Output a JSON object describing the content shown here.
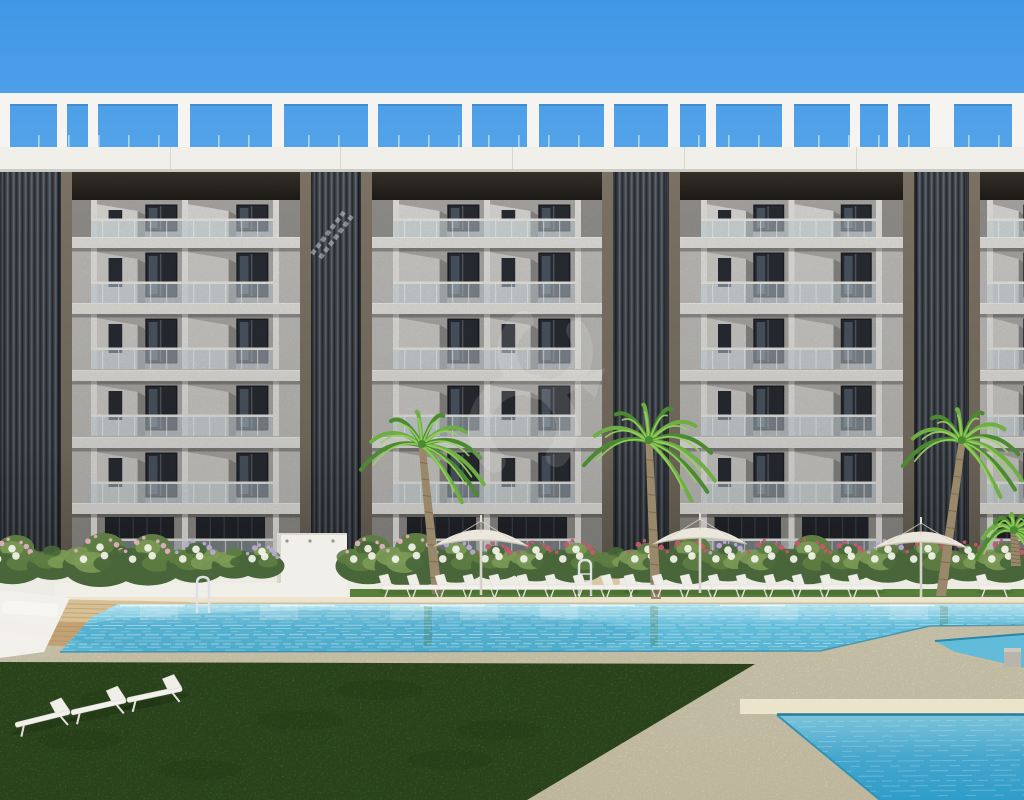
{
  "scene": {
    "description": "Sunny 3D architectural rendering of a modern six-storey apartment residence with a white rooftop pergola, dark vertical louvre towers, glass balconies, palm trees, a flowering hedge, sun loungers, parasols and turquoise communal swimming pools",
    "time_of_day": "day",
    "readable_text": "none",
    "watermark": {
      "present": true,
      "style": "faint white abstract swirl monogram",
      "opacity": 0.13
    }
  },
  "colors": {
    "sky_top": "#4097e6",
    "sky_mid": "#6fb5ef",
    "sky_bottom": "#9ccff5",
    "pergola_white": "#f5f4f0",
    "fascia_white": "#f0efe9",
    "slab_white": "#ecebe6",
    "recess_dark_top": "#3a342c",
    "recess_dark_bottom": "#201d19",
    "facade_light": "#c7c6c3",
    "facade_mid": "#b2b0ad",
    "facade_shadow": "#8f8d8a",
    "wedge_bright": "#d7d5d1",
    "pillar_white": "#edece8",
    "window_dark": "#2b2e35",
    "window_frame": "#1d2026",
    "window_reflection": "#7d91a4",
    "glass_railing": "#cfdde3",
    "rail_white": "#f3f2ee",
    "tower_slat_dark": "#383c42",
    "tower_slat_light": "#5c636b",
    "tower_frame": "#7a7163",
    "ground_wall": "#96948f",
    "ground_glass": "#23262c",
    "wall_white": "#edece4",
    "planter_white": "#f0efe8",
    "hedge_green_dark": "#48663a",
    "hedge_green_mid": "#5d7d42",
    "hedge_green_light": "#7b9a55",
    "flower_pink": "#e2aec2",
    "flower_rose": "#c25a6b",
    "flower_lilac": "#b9a9cf",
    "flower_white": "#eff0e6",
    "palm_trunk": "#99886a",
    "palm_ring": "#77664c",
    "palm_green_dark": "#4c8a32",
    "palm_green_mid": "#6fae45",
    "palm_green_light": "#98d060",
    "umbrella_canopy": "#ebe7dc",
    "umbrella_rib": "#d8d3c5",
    "umbrella_pole": "#d4d2cb",
    "lounger_white": "#f2f1ec",
    "lounger_shade": "#dddbd4",
    "coping_sand": "#ece4cf",
    "sand_top": "#e9e2c8",
    "sand_bottom": "#e3dabb",
    "sand_light": "#ebe4ca",
    "deck_wood_light": "#d8c094",
    "deck_wood_dark": "#c2a274",
    "grass_dark": "#42682c",
    "grass_mid": "#4e7a33",
    "water_light": "#b5e2ee",
    "water_mid": "#62bcd9",
    "water_deep": "#2f9dc8",
    "water_edge": "#2a86a6",
    "ripple": "#dff4f8"
  },
  "building": {
    "storeys": 6,
    "balcony_bays": 4,
    "louvre_towers": 4,
    "pergola": {
      "beam_y": 93,
      "beam_h": 11,
      "band_y": 147,
      "band_h": 25,
      "pillars": [
        [
          0,
          10
        ],
        [
          57,
          10
        ],
        [
          88,
          10
        ],
        [
          178,
          12
        ],
        [
          272,
          12
        ],
        [
          368,
          10
        ],
        [
          462,
          10
        ],
        [
          527,
          12
        ],
        [
          604,
          10
        ],
        [
          668,
          12
        ],
        [
          706,
          10
        ],
        [
          782,
          12
        ],
        [
          850,
          10
        ],
        [
          888,
          10
        ],
        [
          930,
          24
        ],
        [
          1012,
          12
        ]
      ],
      "post_step": 30
    },
    "facade_top": 172,
    "facade_bottom": 560,
    "recess": {
      "y": 172,
      "h": 28
    },
    "penthouse": {
      "y": 200,
      "h": 37
    },
    "slab_ys": [
      237,
      303,
      370,
      437,
      503
    ],
    "slab_h": 11,
    "floor_ys": [
      248,
      314,
      381,
      448
    ],
    "floor_h": 55,
    "ground": {
      "y": 514,
      "h": 46
    },
    "towers": [
      {
        "x": -12,
        "w": 84
      },
      {
        "x": 300,
        "w": 72
      },
      {
        "x": 602,
        "w": 78
      },
      {
        "x": 903,
        "w": 77
      }
    ],
    "stairs_tower_index": 1,
    "bays": [
      {
        "x": 70,
        "w": 230,
        "units": 2,
        "m": 24
      },
      {
        "x": 372,
        "w": 230,
        "units": 2,
        "m": 24
      },
      {
        "x": 680,
        "w": 223,
        "units": 2,
        "m": 24
      },
      {
        "x": 980,
        "w": 80,
        "units": 1,
        "m": 10
      }
    ],
    "fascia_seam_xs": [
      170,
      340,
      512,
      684,
      856
    ]
  },
  "landscape": {
    "wall_y": 556,
    "shower_wall": {
      "x": 277,
      "y": 533,
      "w": 70,
      "h": 64,
      "fixture_xs": [
        287,
        310,
        333
      ]
    },
    "planter": {
      "x": 55,
      "y": 583,
      "w": 230,
      "h": 19
    },
    "boulder": {
      "x": 605,
      "y": 582
    },
    "hedge": [
      [
        12,
        1.3,
        0
      ],
      [
        52,
        1,
        3
      ],
      [
        100,
        1.5,
        0
      ],
      [
        148,
        1.4,
        0
      ],
      [
        196,
        1.2,
        2
      ],
      [
        234,
        0.9,
        3
      ],
      [
        262,
        0.9,
        2
      ],
      [
        368,
        1.3,
        0
      ],
      [
        412,
        1.5,
        0
      ],
      [
        456,
        1.2,
        2
      ],
      [
        496,
        1,
        1
      ],
      [
        536,
        1.1,
        1
      ],
      [
        576,
        1.2,
        1
      ],
      [
        616,
        0.9,
        3
      ],
      [
        648,
        1.2,
        1
      ],
      [
        688,
        1.3,
        1
      ],
      [
        728,
        1.1,
        2
      ],
      [
        768,
        1.2,
        1
      ],
      [
        808,
        1.3,
        1
      ],
      [
        848,
        1.1,
        1
      ],
      [
        888,
        1.2,
        2
      ],
      [
        928,
        1.3,
        1
      ],
      [
        968,
        1.1,
        1
      ],
      [
        1005,
        1.2,
        1
      ]
    ],
    "palms": [
      {
        "cx": 422,
        "cy": 446,
        "r": 62,
        "bx": 437,
        "by": 594
      },
      {
        "cx": 649,
        "cy": 442,
        "r": 66,
        "bx": 656,
        "by": 599
      },
      {
        "cx": 962,
        "cy": 442,
        "r": 60,
        "bx": 941,
        "by": 596
      },
      {
        "cx": 1014,
        "cy": 532,
        "r": 38,
        "bx": 1016,
        "by": 566
      }
    ],
    "umbrellas": [
      {
        "cx": 481,
        "top": 521
      },
      {
        "cx": 700,
        "top": 519
      },
      {
        "cx": 921,
        "top": 523
      }
    ],
    "loungers_row": {
      "y": 585,
      "xs": [
        398,
        426,
        454,
        482,
        508,
        536,
        564,
        592,
        620,
        643,
        671,
        699,
        727,
        755,
        783,
        811,
        839,
        867,
        995
      ]
    },
    "corner_loungers": [
      {
        "x": 42,
        "y": 716,
        "rot": -14
      },
      {
        "x": 98,
        "y": 704,
        "rot": -13
      },
      {
        "x": 154,
        "y": 692,
        "rot": -12
      }
    ],
    "ladders": [
      {
        "x": 203,
        "y": 583
      },
      {
        "x": 585,
        "y": 566
      }
    ],
    "grass_strip": {
      "x": 350,
      "y": 589,
      "w": 674,
      "h": 9
    },
    "lawn": [
      [
        0,
        662
      ],
      [
        755,
        664
      ],
      [
        527,
        800
      ],
      [
        0,
        800
      ]
    ],
    "lawn_mottles": [
      [
        120,
        700
      ],
      [
        300,
        720
      ],
      [
        450,
        760
      ],
      [
        200,
        770
      ],
      [
        380,
        690
      ],
      [
        80,
        740
      ],
      [
        500,
        730
      ]
    ],
    "wood_deck": [
      [
        [
          0,
          598
        ],
        [
          190,
          602
        ],
        [
          160,
          624
        ],
        [
          0,
          620
        ]
      ],
      [
        [
          0,
          620
        ],
        [
          160,
          624
        ],
        [
          120,
          648
        ],
        [
          0,
          644
        ]
      ]
    ],
    "platform": [
      [
        0,
        590
      ],
      [
        70,
        598
      ],
      [
        44,
        652
      ],
      [
        0,
        658
      ]
    ]
  },
  "pools": {
    "coping": {
      "x": 55,
      "y": 597,
      "w": 969,
      "h": 7
    },
    "main": [
      [
        118,
        604
      ],
      [
        1024,
        604
      ],
      [
        1024,
        625
      ],
      [
        930,
        626
      ],
      [
        820,
        651
      ],
      [
        60,
        652
      ],
      [
        92,
        617
      ]
    ],
    "channel": [
      [
        935,
        641
      ],
      [
        1024,
        634
      ],
      [
        1024,
        668
      ],
      [
        955,
        652
      ]
    ],
    "cube": {
      "x": 1004,
      "y": 648,
      "w": 17,
      "h": 19
    },
    "secondary": [
      [
        777,
        715
      ],
      [
        1024,
        715
      ],
      [
        1024,
        800
      ],
      [
        880,
        800
      ]
    ],
    "secondary_band": {
      "x": 740,
      "y": 699,
      "w": 284,
      "h": 15
    },
    "reflection_xs": [
      140,
      260,
      390,
      460,
      540,
      760,
      890
    ],
    "trunk_reflection_xs": [
      424,
      650,
      940
    ]
  }
}
